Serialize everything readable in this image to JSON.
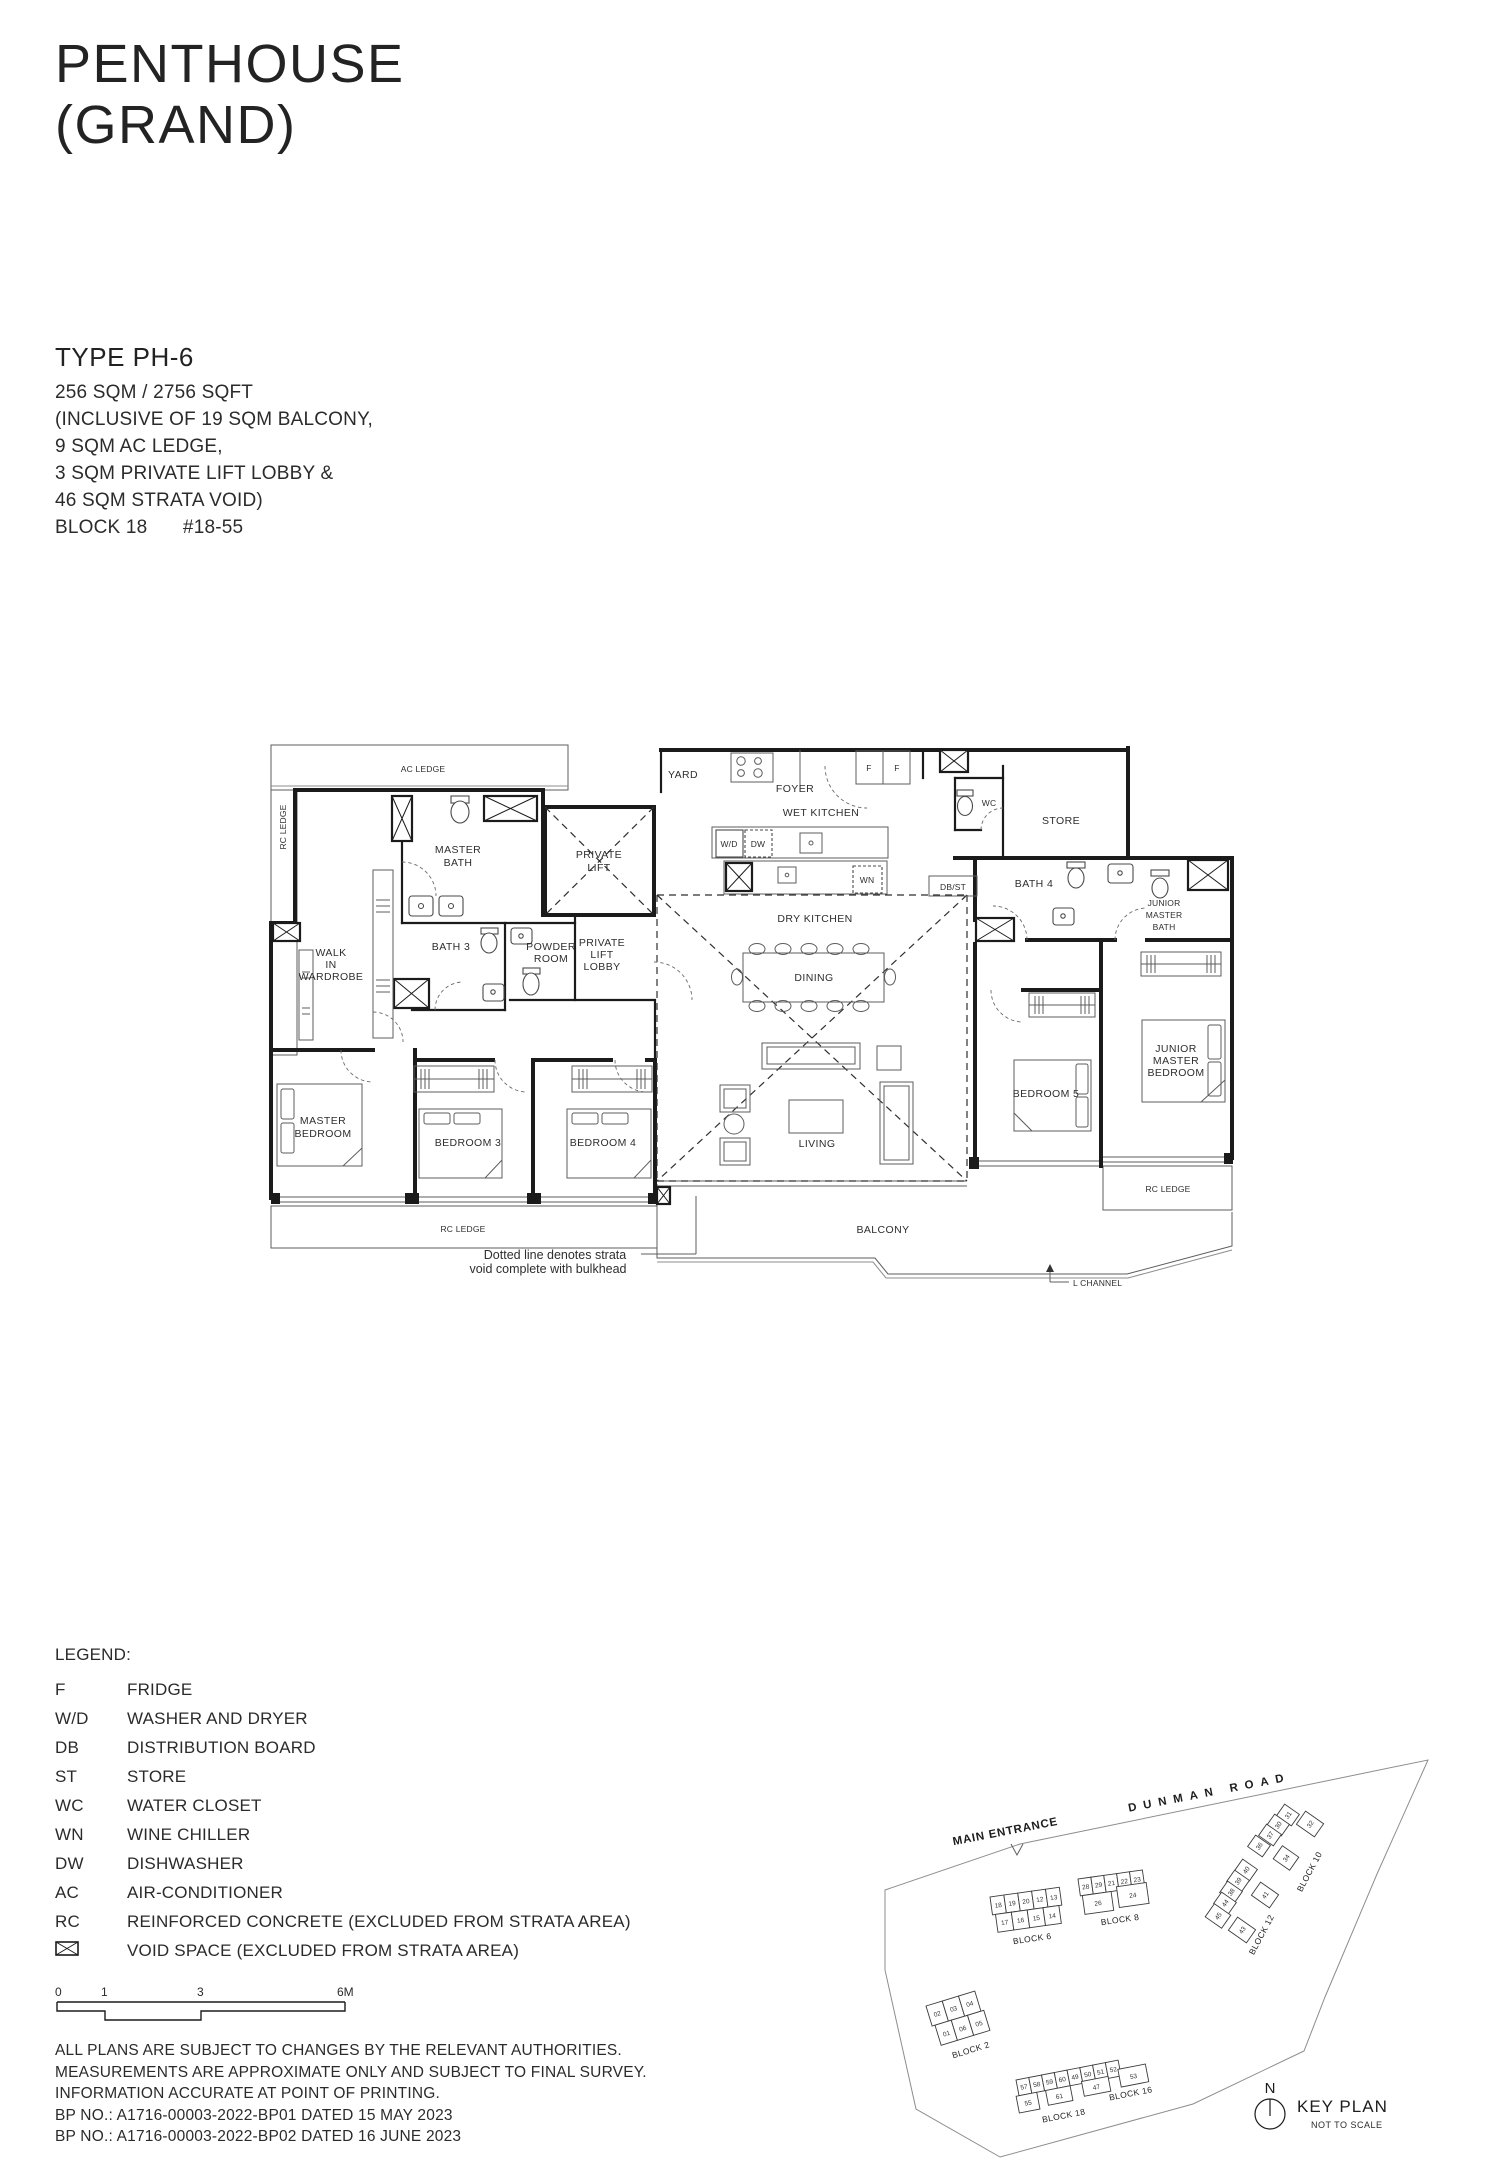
{
  "title": {
    "line1": "PENTHOUSE",
    "line2": "(GRAND)"
  },
  "unit_info": {
    "type": "TYPE PH-6",
    "area": "256 SQM / 2756 SQFT",
    "inclusive_1": "(INCLUSIVE OF 19 SQM BALCONY,",
    "inclusive_2": "9 SQM AC LEDGE,",
    "inclusive_3": "3 SQM PRIVATE LIFT LOBBY &",
    "inclusive_4": "46 SQM STRATA VOID)",
    "block": "BLOCK 18",
    "unit_no": "#18-55"
  },
  "plan": {
    "labels": {
      "ac_ledge": "AC LEDGE",
      "rc_ledge_left": "RC LEDGE",
      "rc_ledge_bottom": "RC LEDGE",
      "rc_ledge_right": "RC LEDGE",
      "master_bath": [
        "MASTER",
        "BATH"
      ],
      "private_lift": [
        "PRIVATE",
        "LIFT"
      ],
      "walk_in_wardrobe": [
        "WALK",
        "IN",
        "WARDROBE"
      ],
      "bath_3": "BATH 3",
      "powder_room": [
        "POWDER",
        "ROOM"
      ],
      "private_lift_lobby": [
        "PRIVATE",
        "LIFT",
        "LOBBY"
      ],
      "yard": "YARD",
      "foyer": "FOYER",
      "wet_kitchen": "WET KITCHEN",
      "wc": "WC",
      "store": "STORE",
      "dry_kitchen": "DRY KITCHEN",
      "dining": "DINING",
      "living": "LIVING",
      "balcony": "BALCONY",
      "bath_4": "BATH 4",
      "junior_master_bath": [
        "JUNIOR",
        "MASTER",
        "BATH"
      ],
      "junior_master_bedroom": [
        "JUNIOR",
        "MASTER",
        "BEDROOM"
      ],
      "bedroom_5": "BEDROOM 5",
      "master_bedroom": [
        "MASTER",
        "BEDROOM"
      ],
      "bedroom_3": "BEDROOM 3",
      "bedroom_4": "BEDROOM 4"
    },
    "appliances": {
      "fridge_1": "F",
      "fridge_2": "F",
      "washer_dryer": "W/D",
      "dishwasher": "DW",
      "wine_chiller": "WN",
      "db_store": "DB/ST"
    },
    "annotations": {
      "strata_note_1": "Dotted line denotes strata",
      "strata_note_2": "void complete with bulkhead",
      "l_channel": "L CHANNEL"
    }
  },
  "legend": {
    "heading": "LEGEND:",
    "items": [
      {
        "abbr": "F",
        "desc": "FRIDGE"
      },
      {
        "abbr": "W/D",
        "desc": "WASHER AND DRYER"
      },
      {
        "abbr": "DB",
        "desc": "DISTRIBUTION BOARD"
      },
      {
        "abbr": "ST",
        "desc": "STORE"
      },
      {
        "abbr": "WC",
        "desc": "WATER CLOSET"
      },
      {
        "abbr": "WN",
        "desc": "WINE CHILLER"
      },
      {
        "abbr": "DW",
        "desc": "DISHWASHER"
      },
      {
        "abbr": "AC",
        "desc": "AIR-CONDITIONER"
      },
      {
        "abbr": "RC",
        "desc": "REINFORCED CONCRETE (EXCLUDED FROM STRATA AREA)"
      },
      {
        "abbr": "",
        "desc": "VOID SPACE (EXCLUDED FROM STRATA AREA)"
      }
    ]
  },
  "scale_bar": {
    "t0": "0",
    "t1": "1",
    "t2": "3",
    "t3": "6M"
  },
  "disclaimer": {
    "line_1": "ALL PLANS ARE SUBJECT TO CHANGES BY THE RELEVANT AUTHORITIES.",
    "line_2": "MEASUREMENTS ARE APPROXIMATE ONLY AND SUBJECT TO FINAL SURVEY.",
    "line_3": "INFORMATION ACCURATE AT POINT OF PRINTING.",
    "line_4": "BP NO.: A1716-00003-2022-BP01 DATED 15 MAY 2023",
    "line_5": "BP NO.: A1716-00003-2022-BP02 DATED 16 JUNE 2023"
  },
  "key_plan": {
    "title": "KEY PLAN",
    "subtitle": "NOT TO SCALE",
    "north": "N",
    "road": "DUNMAN ROAD",
    "main_entrance": "MAIN ENTRANCE",
    "highlight_color": "#f3edc0",
    "blocks": [
      {
        "name": "BLOCK 2",
        "units": [
          "02",
          "03",
          "04",
          "01",
          "06",
          "05"
        ]
      },
      {
        "name": "BLOCK 6",
        "units": [
          "18",
          "19",
          "20",
          "12",
          "13",
          "17",
          "16",
          "15",
          "14"
        ]
      },
      {
        "name": "BLOCK 8",
        "units": [
          "28",
          "29",
          "21",
          "22",
          "23",
          "26",
          "24"
        ]
      },
      {
        "name": "BLOCK 10",
        "units": [
          "31",
          "30",
          "37",
          "36",
          "34",
          "32"
        ]
      },
      {
        "name": "BLOCK 12",
        "units": [
          "40",
          "39",
          "38",
          "44",
          "45",
          "41",
          "43"
        ]
      },
      {
        "name": "BLOCK 16",
        "units": [
          "49",
          "50",
          "51",
          "52",
          "47",
          "53"
        ]
      },
      {
        "name": "BLOCK 18",
        "units": [
          "57",
          "58",
          "59",
          "60",
          "61",
          "55"
        ]
      }
    ]
  }
}
